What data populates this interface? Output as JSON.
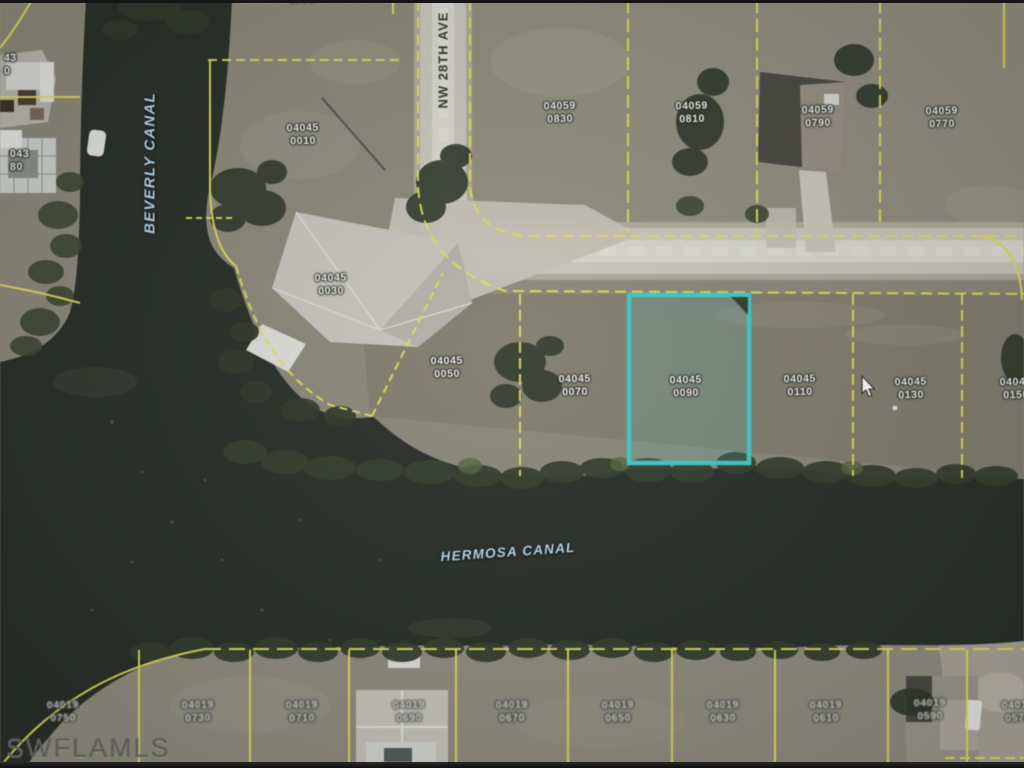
{
  "map": {
    "street_label": "NW 28TH AVE",
    "canal_vertical": "BEVERLY CANAL",
    "canal_horizontal": "HERMOSA CANAL",
    "watermark": "SWFLAMLS",
    "highlighted_parcel": {
      "block": "04045",
      "lot": "0090"
    },
    "colors": {
      "water": "#242b23",
      "land": "#8b8876",
      "road": "#cbc9bd",
      "parcel_line": "#e7e24b",
      "highlight": "#35cccb",
      "label_text": "#f4f4ee",
      "canal_text": "#b7dcee",
      "street_text": "#33332e",
      "watermark_text": "#666664"
    },
    "parcel_labels": [
      {
        "block": "0730",
        "lot": "",
        "x": 302,
        "y": -7
      },
      {
        "block": "04045",
        "lot": "0010",
        "x": 303,
        "y": 122
      },
      {
        "block": "04045",
        "lot": "0030",
        "x": 331,
        "y": 272
      },
      {
        "block": "04045",
        "lot": "0050",
        "x": 447,
        "y": 355
      },
      {
        "block": "04045",
        "lot": "0070",
        "x": 575,
        "y": 373
      },
      {
        "block": "04045",
        "lot": "0090",
        "x": 686,
        "y": 374
      },
      {
        "block": "04045",
        "lot": "0110",
        "x": 800,
        "y": 373
      },
      {
        "block": "04045",
        "lot": "0130",
        "x": 911,
        "y": 376
      },
      {
        "block": "04045",
        "lot": "0150",
        "x": 1016,
        "y": 376
      },
      {
        "block": "04059",
        "lot": "0830",
        "x": 560,
        "y": 100
      },
      {
        "block": "04059",
        "lot": "0810",
        "x": 692,
        "y": 100
      },
      {
        "block": "04059",
        "lot": "0790",
        "x": 818,
        "y": 104
      },
      {
        "block": "04059",
        "lot": "0770",
        "x": 942,
        "y": 105
      },
      {
        "block": "43",
        "lot": "0",
        "x": 4,
        "y": 52,
        "cls": "left"
      },
      {
        "block": "043",
        "lot": "80",
        "x": 10,
        "y": 148,
        "cls": "left"
      },
      {
        "block": "04019",
        "lot": "0750",
        "x": 63,
        "y": 699,
        "cls": "blurry"
      },
      {
        "block": "04019",
        "lot": "0730",
        "x": 198,
        "y": 699,
        "cls": "blurry"
      },
      {
        "block": "04019",
        "lot": "0710",
        "x": 302,
        "y": 699,
        "cls": "blurry"
      },
      {
        "block": "04019",
        "lot": "0690",
        "x": 409,
        "y": 699,
        "cls": "blurry"
      },
      {
        "block": "04019",
        "lot": "0670",
        "x": 512,
        "y": 699,
        "cls": "blurry"
      },
      {
        "block": "04019",
        "lot": "0650",
        "x": 618,
        "y": 699,
        "cls": "blurry"
      },
      {
        "block": "04019",
        "lot": "0630",
        "x": 723,
        "y": 699,
        "cls": "blurry"
      },
      {
        "block": "04019",
        "lot": "0610",
        "x": 826,
        "y": 699,
        "cls": "blurry"
      },
      {
        "block": "04019",
        "lot": "0590",
        "x": 930,
        "y": 697,
        "cls": "blurry"
      },
      {
        "block": "04019",
        "lot": "0570",
        "x": 1018,
        "y": 699,
        "cls": "blurry"
      }
    ]
  }
}
